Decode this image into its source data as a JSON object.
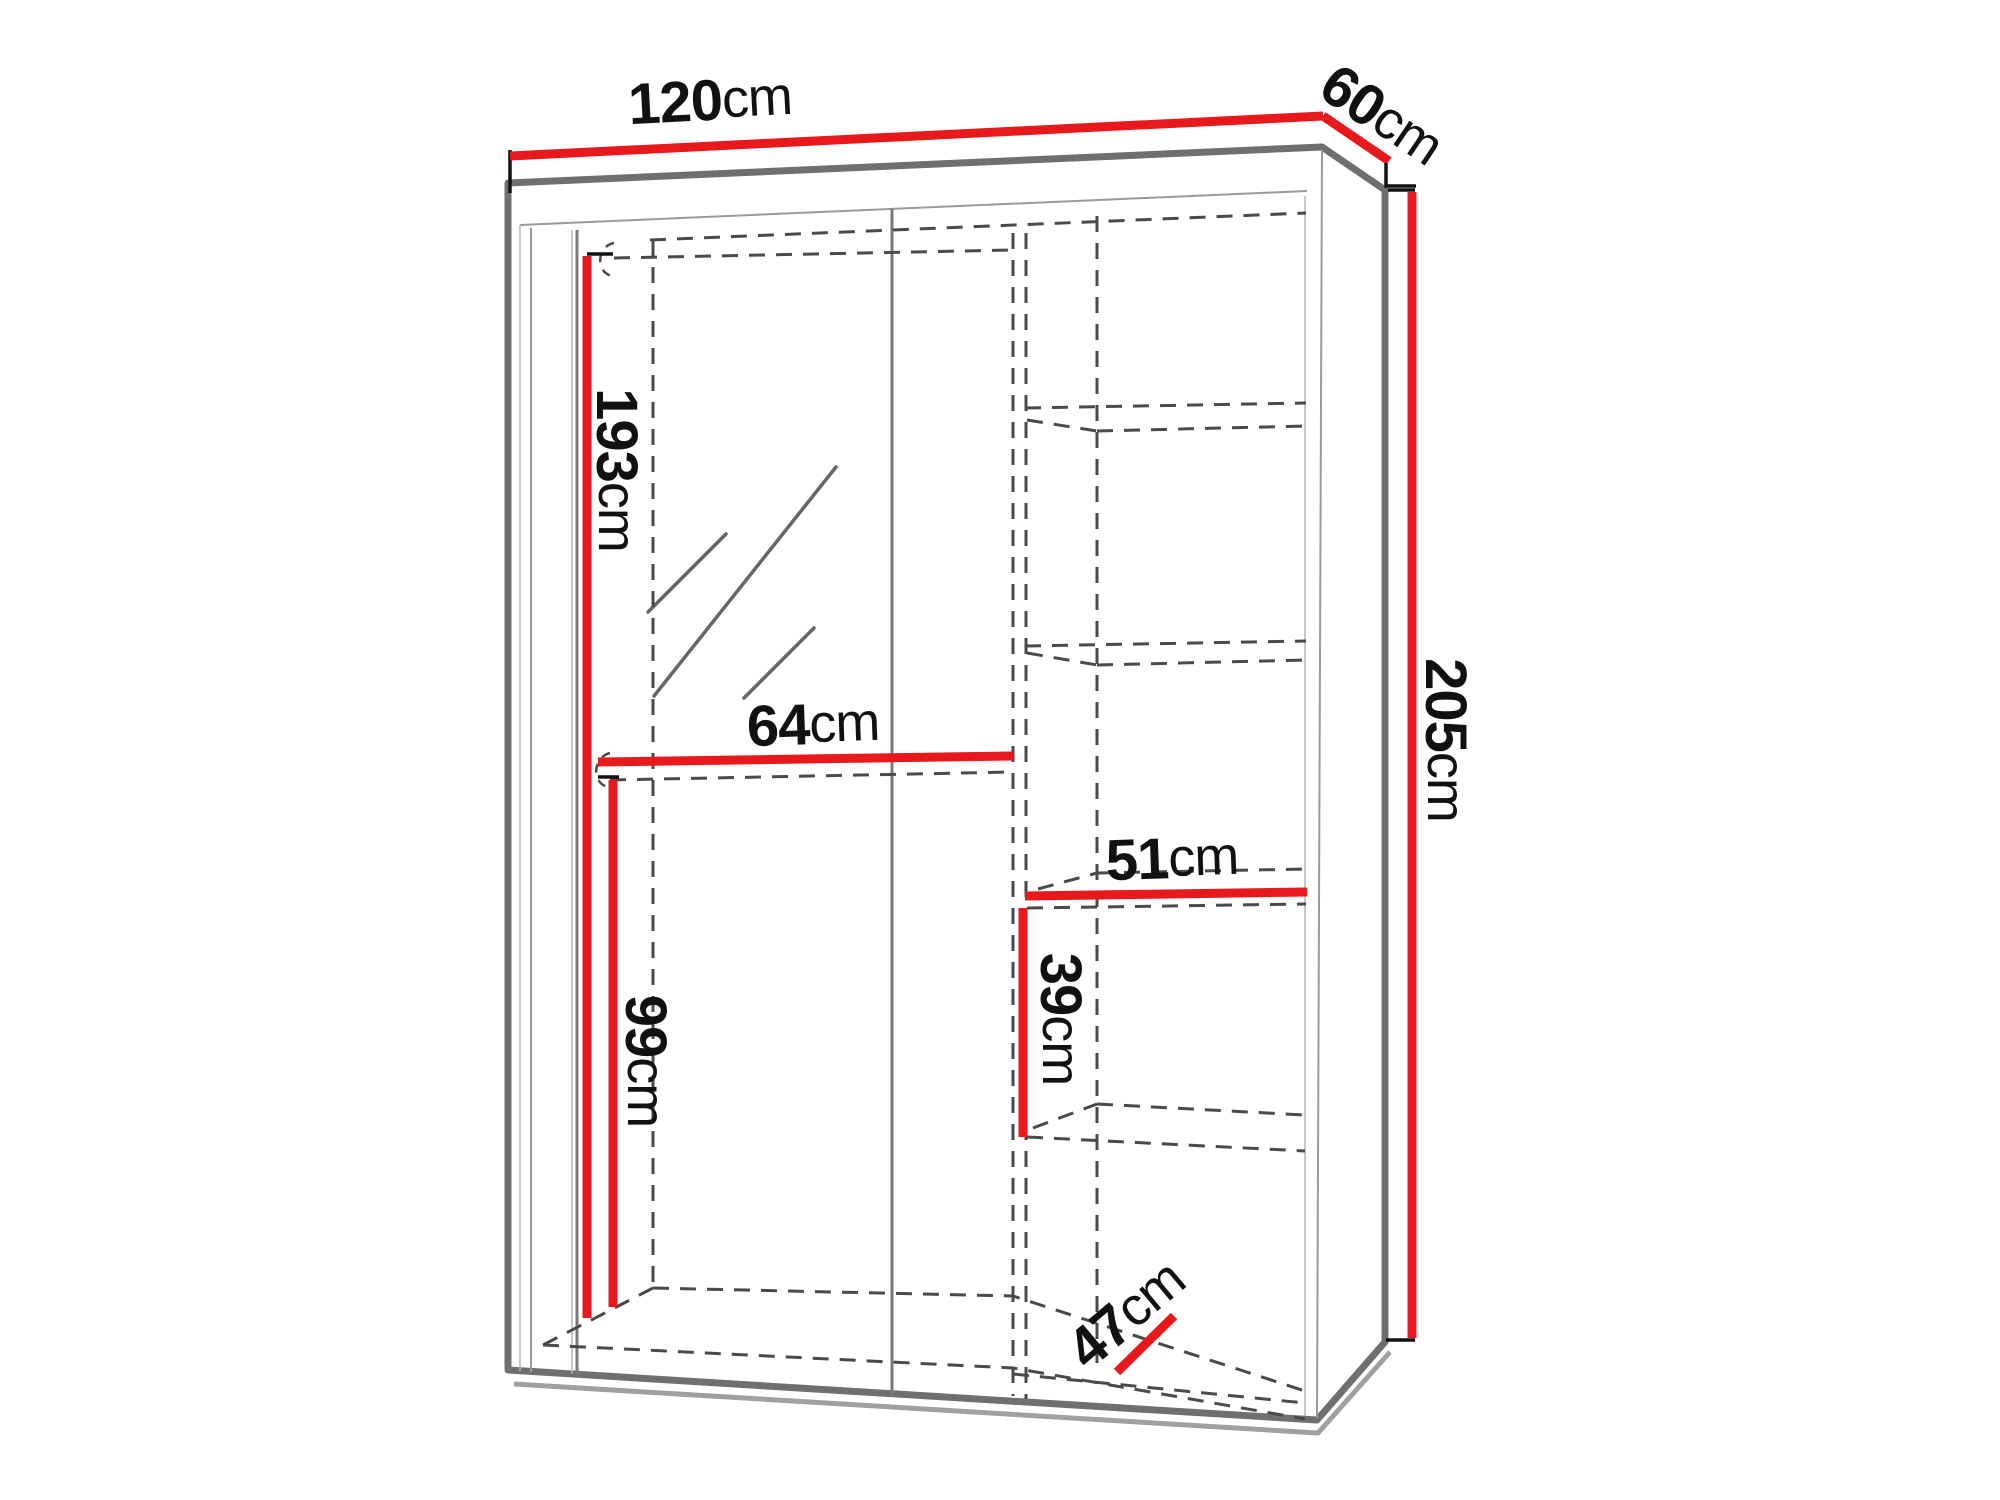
{
  "diagram": {
    "title": "Wardrobe dimensions diagram",
    "subject": "Sliding-door wardrobe with mirror, interior shelving column and two hanging rods, shown in perspective with overall and interior measurements",
    "unit": "cm",
    "colors": {
      "dimension_line": "#e8191c",
      "outline": "#6f6f6f",
      "hidden_line": "#4a4a4a",
      "label": "#111111",
      "background": "#ffffff"
    },
    "dimensions": [
      {
        "id": "overall-width",
        "value": "120",
        "unit": "cm"
      },
      {
        "id": "overall-depth",
        "value": "60",
        "unit": "cm"
      },
      {
        "id": "overall-height",
        "value": "205",
        "unit": "cm"
      },
      {
        "id": "interior-height",
        "value": "193",
        "unit": "cm"
      },
      {
        "id": "hanging-section-width",
        "value": "64",
        "unit": "cm"
      },
      {
        "id": "lower-section-height",
        "value": "99",
        "unit": "cm"
      },
      {
        "id": "shelf-width",
        "value": "51",
        "unit": "cm"
      },
      {
        "id": "shelf-spacing-height",
        "value": "39",
        "unit": "cm"
      },
      {
        "id": "shelf-depth",
        "value": "47",
        "unit": "cm"
      }
    ]
  }
}
